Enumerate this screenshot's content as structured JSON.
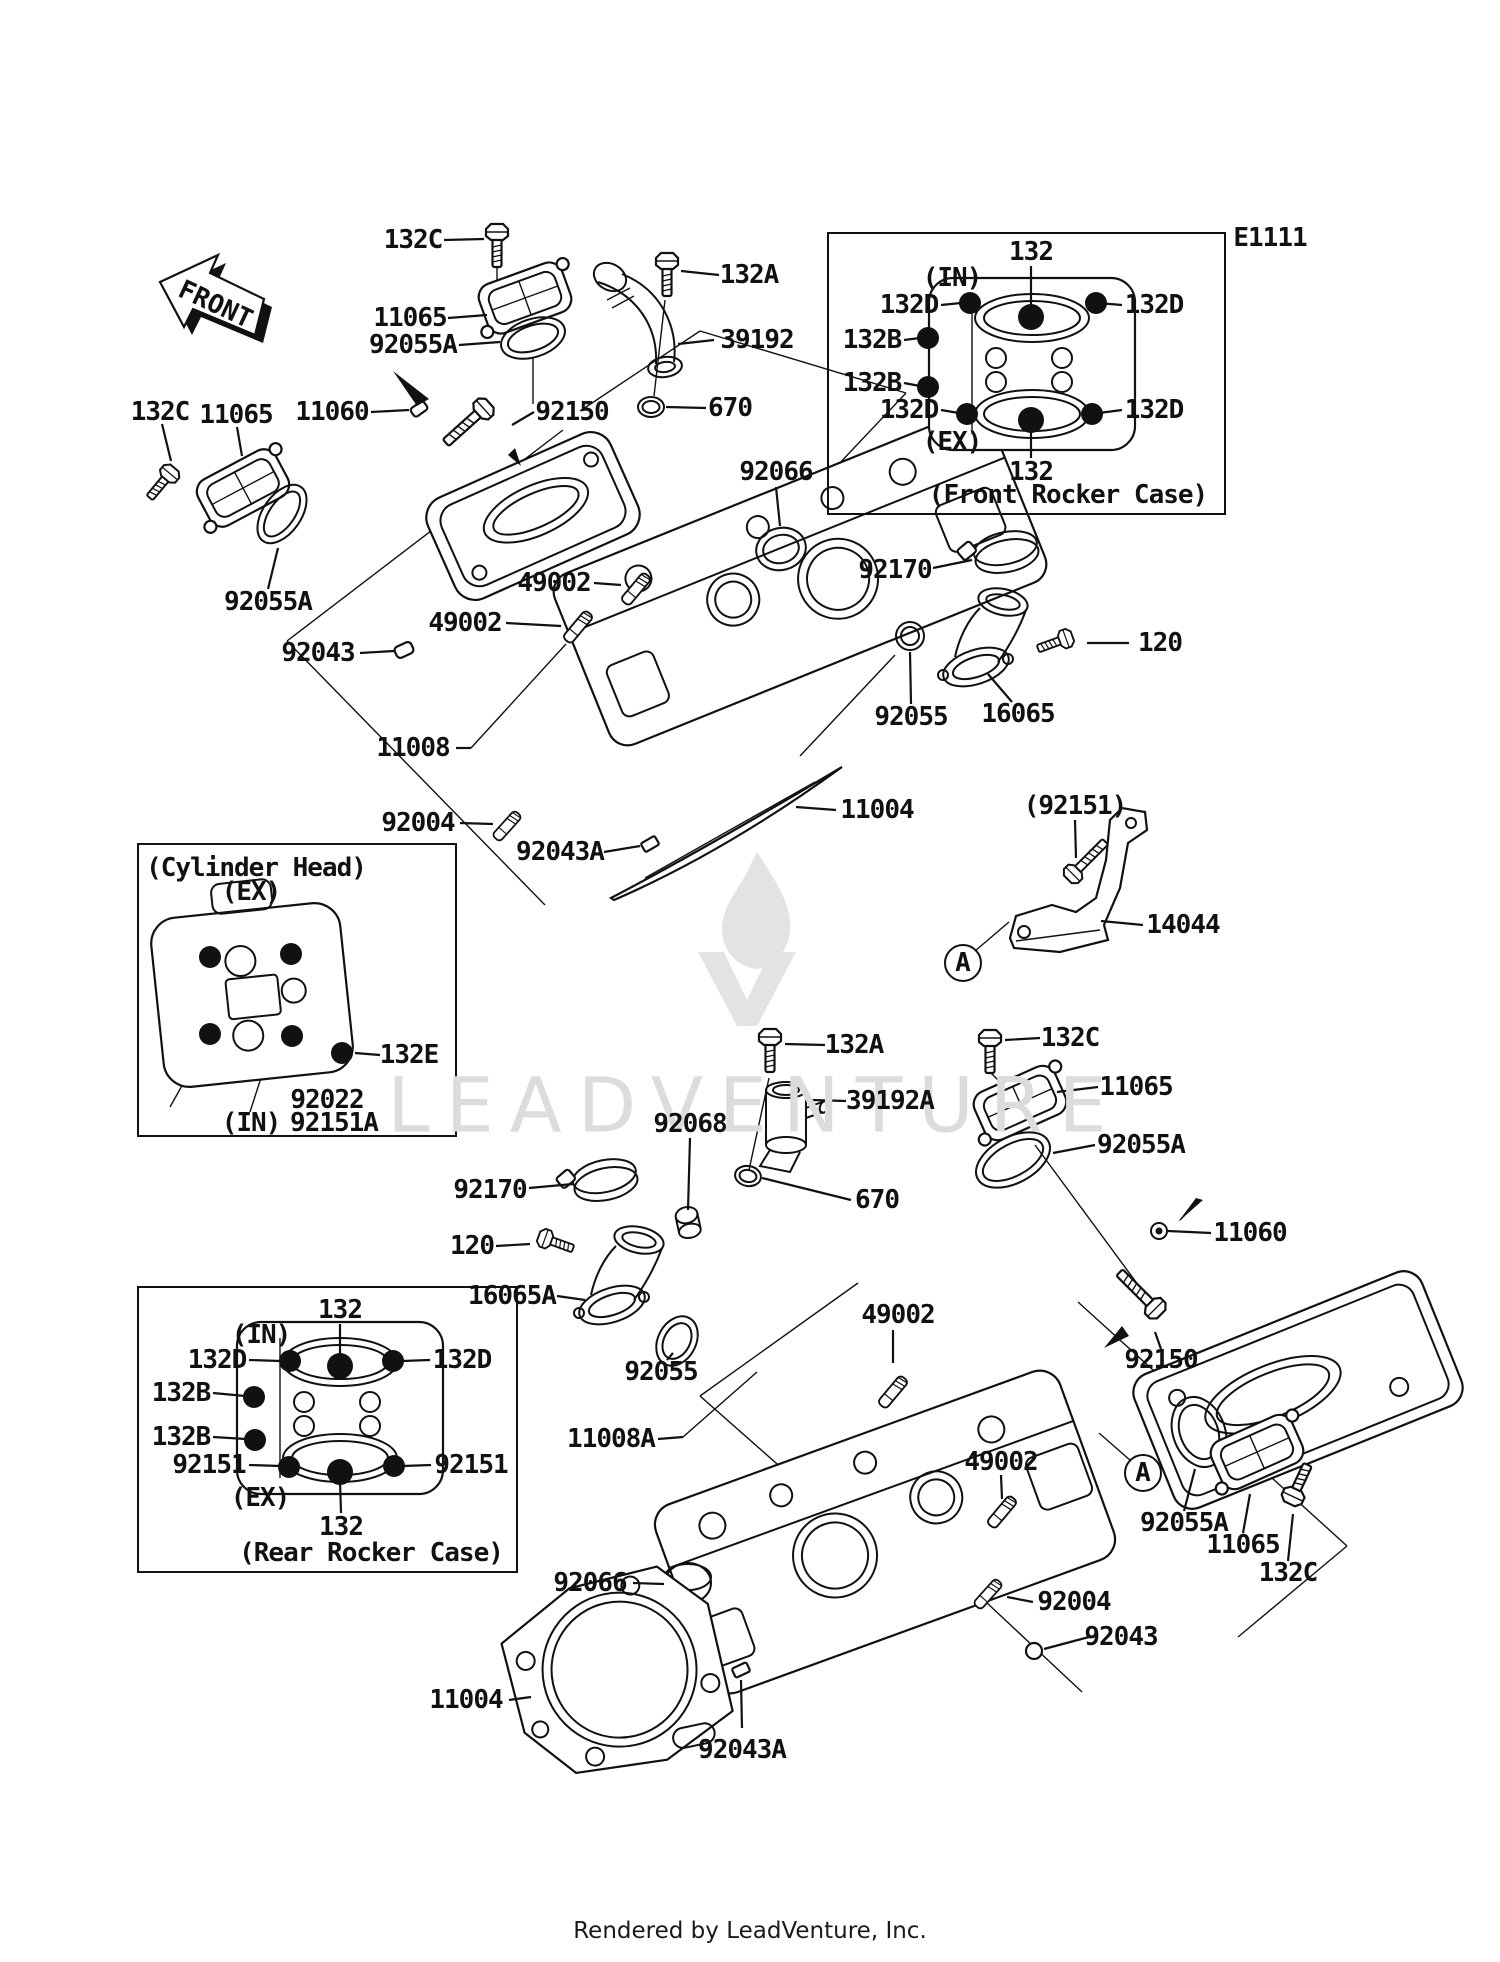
{
  "page": {
    "diagram_code": "E1111",
    "front_arrow_text": "FRONT",
    "watermark": "LEADVENTURE",
    "footer": "Rendered by LeadVenture, Inc."
  },
  "insets": [
    {
      "name": "front-rocker-case",
      "x": 827,
      "y": 232,
      "w": 399,
      "h": 283
    },
    {
      "name": "cylinder-head",
      "x": 137,
      "y": 843,
      "w": 320,
      "h": 294
    },
    {
      "name": "rear-rocker-case",
      "x": 137,
      "y": 1286,
      "w": 381,
      "h": 287
    }
  ],
  "labels": [
    {
      "text": "E1111",
      "x": 1270,
      "y": 238,
      "kind": "caption"
    },
    {
      "text": "132C",
      "x": 413,
      "y": 240,
      "lead": [
        444,
        240,
        484,
        239
      ]
    },
    {
      "text": "11065",
      "x": 410,
      "y": 318,
      "lead": [
        448,
        318,
        487,
        315
      ]
    },
    {
      "text": "92055A",
      "x": 413,
      "y": 345,
      "lead": [
        459,
        345,
        500,
        342
      ]
    },
    {
      "text": "132A",
      "x": 749,
      "y": 275,
      "lead": [
        719,
        275,
        681,
        271
      ]
    },
    {
      "text": "39192",
      "x": 757,
      "y": 340,
      "lead": [
        714,
        340,
        678,
        344
      ]
    },
    {
      "text": "11060",
      "x": 332,
      "y": 412,
      "lead": [
        371,
        412,
        409,
        410
      ]
    },
    {
      "text": "92150",
      "x": 572,
      "y": 412,
      "lead": [
        534,
        412,
        512,
        425
      ]
    },
    {
      "text": "670",
      "x": 730,
      "y": 408,
      "lead": [
        706,
        408,
        666,
        407
      ]
    },
    {
      "text": "92066",
      "x": 776,
      "y": 472,
      "lead": [
        776,
        487,
        780,
        526
      ]
    },
    {
      "text": "92170",
      "x": 895,
      "y": 570,
      "lead": [
        933,
        568,
        972,
        560
      ]
    },
    {
      "text": "120",
      "x": 1160,
      "y": 643,
      "lead": [
        1129,
        643,
        1087,
        643
      ]
    },
    {
      "text": "16065",
      "x": 1018,
      "y": 714,
      "lead": [
        1012,
        702,
        988,
        674
      ]
    },
    {
      "text": "92055",
      "x": 911,
      "y": 717,
      "lead": [
        911,
        704,
        910,
        652
      ]
    },
    {
      "text": "132C",
      "x": 160,
      "y": 412,
      "lead": [
        162,
        424,
        171,
        461
      ]
    },
    {
      "text": "11065",
      "x": 236,
      "y": 415,
      "lead": [
        237,
        427,
        242,
        456
      ]
    },
    {
      "text": "92055A",
      "x": 268,
      "y": 602,
      "lead": [
        268,
        589,
        278,
        548
      ]
    },
    {
      "text": "92043",
      "x": 318,
      "y": 653,
      "lead": [
        360,
        653,
        394,
        651
      ]
    },
    {
      "text": "49002",
      "x": 554,
      "y": 583,
      "lead": [
        594,
        583,
        621,
        585
      ]
    },
    {
      "text": "49002",
      "x": 465,
      "y": 623,
      "lead": [
        506,
        623,
        561,
        626
      ]
    },
    {
      "text": "11008",
      "x": 413,
      "y": 748,
      "lead": [
        456,
        748,
        471,
        748
      ]
    },
    {
      "text": "92004",
      "x": 418,
      "y": 823,
      "lead": [
        460,
        823,
        493,
        824
      ]
    },
    {
      "text": "92043A",
      "x": 560,
      "y": 852,
      "lead": [
        604,
        852,
        640,
        846
      ]
    },
    {
      "text": "11004",
      "x": 877,
      "y": 810,
      "lead": [
        836,
        810,
        796,
        807
      ]
    },
    {
      "text": "(92151)",
      "x": 1075,
      "y": 806,
      "lead": [
        1075,
        820,
        1076,
        858
      ]
    },
    {
      "text": "14044",
      "x": 1183,
      "y": 925,
      "lead": [
        1143,
        925,
        1101,
        921
      ]
    },
    {
      "text": "A",
      "x": 963,
      "y": 963,
      "shape": "circle"
    },
    {
      "text": "132",
      "x": 1031,
      "y": 252,
      "lead": [
        1031,
        266,
        1031,
        311
      ]
    },
    {
      "text": "(IN)",
      "x": 952,
      "y": 278,
      "kind": "caption"
    },
    {
      "text": "132D",
      "x": 909,
      "y": 305,
      "lead": [
        941,
        305,
        961,
        303
      ]
    },
    {
      "text": "132D",
      "x": 1154,
      "y": 305,
      "lead": [
        1122,
        305,
        1098,
        303
      ]
    },
    {
      "text": "132B",
      "x": 872,
      "y": 340,
      "lead": [
        904,
        340,
        920,
        338
      ]
    },
    {
      "text": "132B",
      "x": 872,
      "y": 383,
      "lead": [
        904,
        383,
        920,
        386
      ]
    },
    {
      "text": "132D",
      "x": 909,
      "y": 410,
      "lead": [
        941,
        410,
        959,
        413
      ]
    },
    {
      "text": "132D",
      "x": 1154,
      "y": 410,
      "lead": [
        1122,
        410,
        1099,
        413
      ]
    },
    {
      "text": "(EX)",
      "x": 952,
      "y": 442,
      "kind": "caption"
    },
    {
      "text": "132",
      "x": 1031,
      "y": 472,
      "lead": [
        1031,
        458,
        1031,
        426
      ]
    },
    {
      "text": "(Front Rocker Case)",
      "x": 1068,
      "y": 495,
      "kind": "caption"
    },
    {
      "text": "(Cylinder Head)",
      "x": 256,
      "y": 868,
      "kind": "caption"
    },
    {
      "text": "(EX)",
      "x": 251,
      "y": 892,
      "kind": "caption"
    },
    {
      "text": "132E",
      "x": 409,
      "y": 1055,
      "lead": [
        380,
        1055,
        355,
        1053
      ]
    },
    {
      "text": "92022",
      "x": 327,
      "y": 1100
    },
    {
      "text": "92151A",
      "x": 334,
      "y": 1123
    },
    {
      "text": "(IN)",
      "x": 251,
      "y": 1123,
      "kind": "caption"
    },
    {
      "text": "132A",
      "x": 854,
      "y": 1045,
      "lead": [
        825,
        1045,
        785,
        1044
      ]
    },
    {
      "text": "132C",
      "x": 1070,
      "y": 1038,
      "lead": [
        1040,
        1038,
        1005,
        1040
      ]
    },
    {
      "text": "11065",
      "x": 1136,
      "y": 1087,
      "lead": [
        1098,
        1087,
        1057,
        1092
      ]
    },
    {
      "text": "39192A",
      "x": 890,
      "y": 1101,
      "lead": [
        846,
        1101,
        811,
        1100
      ]
    },
    {
      "text": "92055A",
      "x": 1141,
      "y": 1145,
      "lead": [
        1095,
        1145,
        1053,
        1153
      ]
    },
    {
      "text": "92068",
      "x": 690,
      "y": 1124,
      "lead": [
        690,
        1138,
        688,
        1210
      ]
    },
    {
      "text": "670",
      "x": 877,
      "y": 1200,
      "lead": [
        851,
        1200,
        762,
        1178
      ]
    },
    {
      "text": "92170",
      "x": 490,
      "y": 1190,
      "lead": [
        529,
        1188,
        573,
        1184
      ]
    },
    {
      "text": "11060",
      "x": 1250,
      "y": 1233,
      "lead": [
        1211,
        1233,
        1168,
        1231
      ]
    },
    {
      "text": "120",
      "x": 472,
      "y": 1246,
      "lead": [
        496,
        1246,
        530,
        1244
      ]
    },
    {
      "text": "16065A",
      "x": 512,
      "y": 1296,
      "lead": [
        557,
        1296,
        585,
        1300
      ]
    },
    {
      "text": "49002",
      "x": 898,
      "y": 1315,
      "lead": [
        893,
        1330,
        893,
        1363
      ]
    },
    {
      "text": "92055",
      "x": 661,
      "y": 1372,
      "lead": [
        667,
        1360,
        673,
        1353
      ]
    },
    {
      "text": "92150",
      "x": 1161,
      "y": 1360,
      "lead": [
        1161,
        1349,
        1155,
        1332
      ]
    },
    {
      "text": "11008A",
      "x": 611,
      "y": 1439,
      "lead": [
        658,
        1439,
        683,
        1437
      ]
    },
    {
      "text": "49002",
      "x": 1001,
      "y": 1462,
      "lead": [
        1001,
        1475,
        1002,
        1499
      ]
    },
    {
      "text": "92066",
      "x": 590,
      "y": 1583,
      "lead": [
        633,
        1583,
        664,
        1584
      ]
    },
    {
      "text": "92055A",
      "x": 1184,
      "y": 1523,
      "lead": [
        1184,
        1511,
        1195,
        1469
      ]
    },
    {
      "text": "11065",
      "x": 1243,
      "y": 1545,
      "lead": [
        1243,
        1533,
        1250,
        1494
      ]
    },
    {
      "text": "132C",
      "x": 1288,
      "y": 1573,
      "lead": [
        1288,
        1561,
        1293,
        1514
      ]
    },
    {
      "text": "92004",
      "x": 1074,
      "y": 1602,
      "lead": [
        1033,
        1602,
        1007,
        1597
      ]
    },
    {
      "text": "92043",
      "x": 1121,
      "y": 1637,
      "lead": [
        1089,
        1637,
        1044,
        1649
      ]
    },
    {
      "text": "11004",
      "x": 466,
      "y": 1700,
      "lead": [
        509,
        1700,
        531,
        1697
      ]
    },
    {
      "text": "92043A",
      "x": 742,
      "y": 1750,
      "lead": [
        742,
        1728,
        741,
        1680
      ]
    },
    {
      "text": "A",
      "x": 1143,
      "y": 1473,
      "shape": "circle"
    },
    {
      "text": "132",
      "x": 340,
      "y": 1310,
      "lead": [
        340,
        1324,
        340,
        1359
      ]
    },
    {
      "text": "(IN)",
      "x": 261,
      "y": 1335,
      "kind": "caption"
    },
    {
      "text": "132D",
      "x": 217,
      "y": 1360,
      "lead": [
        249,
        1360,
        280,
        1361
      ]
    },
    {
      "text": "132D",
      "x": 462,
      "y": 1360,
      "lead": [
        430,
        1360,
        402,
        1361
      ]
    },
    {
      "text": "132B",
      "x": 181,
      "y": 1393,
      "lead": [
        213,
        1393,
        245,
        1396
      ]
    },
    {
      "text": "132B",
      "x": 181,
      "y": 1437,
      "lead": [
        213,
        1437,
        246,
        1439
      ]
    },
    {
      "text": "92151",
      "x": 209,
      "y": 1465,
      "lead": [
        249,
        1465,
        280,
        1466
      ]
    },
    {
      "text": "92151",
      "x": 471,
      "y": 1465,
      "lead": [
        431,
        1465,
        403,
        1466
      ]
    },
    {
      "text": "(EX)",
      "x": 260,
      "y": 1498,
      "kind": "caption"
    },
    {
      "text": "132",
      "x": 341,
      "y": 1527,
      "lead": [
        341,
        1513,
        340,
        1480
      ]
    },
    {
      "text": "(Rear Rocker Case)",
      "x": 371,
      "y": 1553,
      "kind": "caption"
    }
  ],
  "callout_dots": [
    [
      970,
      303
    ],
    [
      1096,
      303
    ],
    [
      928,
      338
    ],
    [
      928,
      387
    ],
    [
      967,
      414
    ],
    [
      1092,
      414
    ],
    [
      1031,
      317,
      13
    ],
    [
      1031,
      420,
      13
    ],
    [
      290,
      1361
    ],
    [
      393,
      1361
    ],
    [
      254,
      1397
    ],
    [
      255,
      1440
    ],
    [
      289,
      1467
    ],
    [
      394,
      1466
    ],
    [
      340,
      1366,
      13
    ],
    [
      340,
      1472,
      13
    ],
    [
      210,
      957
    ],
    [
      291,
      954
    ],
    [
      210,
      1034
    ],
    [
      292,
      1036
    ],
    [
      342,
      1053
    ]
  ]
}
